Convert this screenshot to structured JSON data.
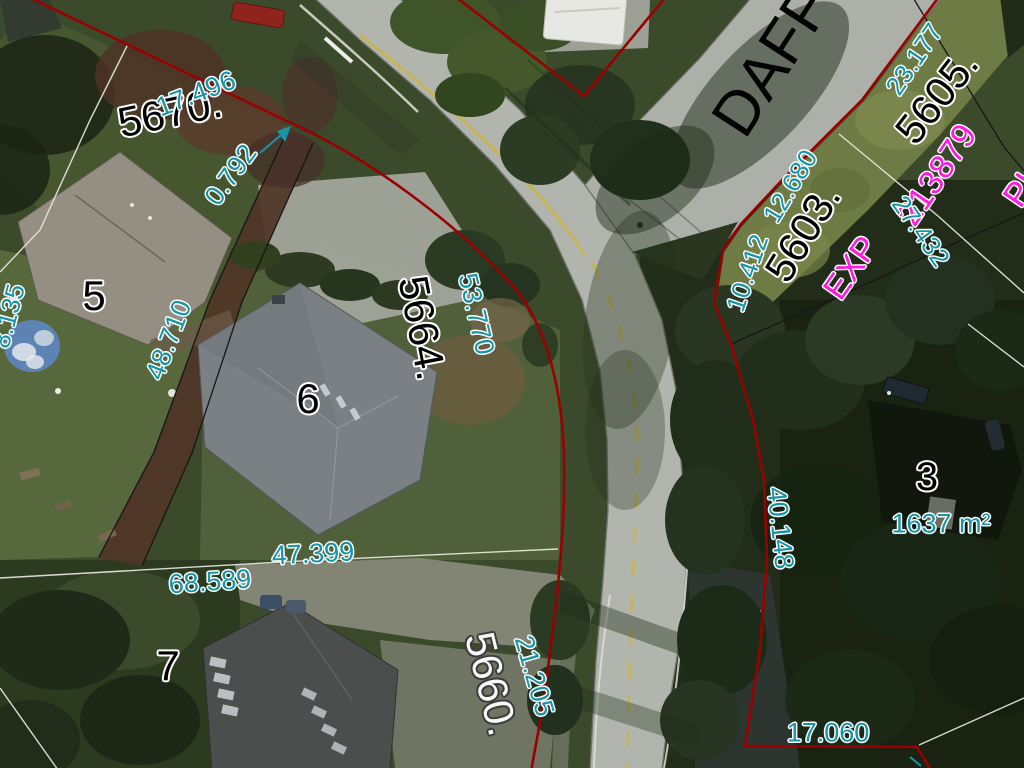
{
  "colors": {
    "measurement_text": "#1794a6",
    "parcel_text": "#000000",
    "parcel_text_light": "#f8f8f8",
    "plan_text": "#ff1ae0",
    "street_text": "#000000",
    "boundary_red": "#9b0000",
    "boundary_black": "#161616",
    "boundary_white": "#e9e9e4"
  },
  "street": {
    "name": "DAFF"
  },
  "labels": [
    {
      "id": "street-name",
      "text": "DAFF",
      "kind": "street"
    },
    {
      "id": "parcel-5670",
      "text": "5670.",
      "kind": "parcel"
    },
    {
      "id": "dim-17496",
      "text": "17.496",
      "kind": "measurement"
    },
    {
      "id": "dim-0792",
      "text": "0.792",
      "kind": "measurement"
    },
    {
      "id": "dim-8135",
      "text": "8.135",
      "kind": "measurement"
    },
    {
      "id": "lot-5",
      "text": "5",
      "kind": "lot"
    },
    {
      "id": "dim-48710",
      "text": "48.710",
      "kind": "measurement"
    },
    {
      "id": "parcel-5664",
      "text": "5664.",
      "kind": "parcel"
    },
    {
      "id": "dim-53770",
      "text": "53.770",
      "kind": "measurement"
    },
    {
      "id": "lot-6",
      "text": "6",
      "kind": "lot"
    },
    {
      "id": "dim-47399",
      "text": "47.399",
      "kind": "measurement"
    },
    {
      "id": "dim-68589",
      "text": "68.589",
      "kind": "measurement"
    },
    {
      "id": "lot-7",
      "text": "7",
      "kind": "lot"
    },
    {
      "id": "parcel-5660",
      "text": "5660.",
      "kind": "parcel-light"
    },
    {
      "id": "dim-21205",
      "text": "21.205",
      "kind": "measurement"
    },
    {
      "id": "dim-17060",
      "text": "17.060",
      "kind": "measurement"
    },
    {
      "id": "dim-40148",
      "text": "40.148",
      "kind": "measurement"
    },
    {
      "id": "lot-3",
      "text": "3",
      "kind": "lot"
    },
    {
      "id": "area-1637",
      "text": "1637 m²",
      "kind": "measurement"
    },
    {
      "id": "dim-10412",
      "text": "10.412",
      "kind": "measurement"
    },
    {
      "id": "dim-12680",
      "text": "12.680",
      "kind": "measurement"
    },
    {
      "id": "parcel-5603",
      "text": "5603.",
      "kind": "parcel"
    },
    {
      "id": "plan-exp",
      "text": "EXP",
      "kind": "plan"
    },
    {
      "id": "plan-213879",
      "text": "213879",
      "kind": "plan"
    },
    {
      "id": "dim-27432",
      "text": "27.432",
      "kind": "measurement"
    },
    {
      "id": "parcel-5605",
      "text": "5605.",
      "kind": "parcel"
    },
    {
      "id": "dim-23177",
      "text": "23.177",
      "kind": "measurement"
    },
    {
      "id": "plan-partial",
      "text": "PL",
      "kind": "plan"
    }
  ]
}
